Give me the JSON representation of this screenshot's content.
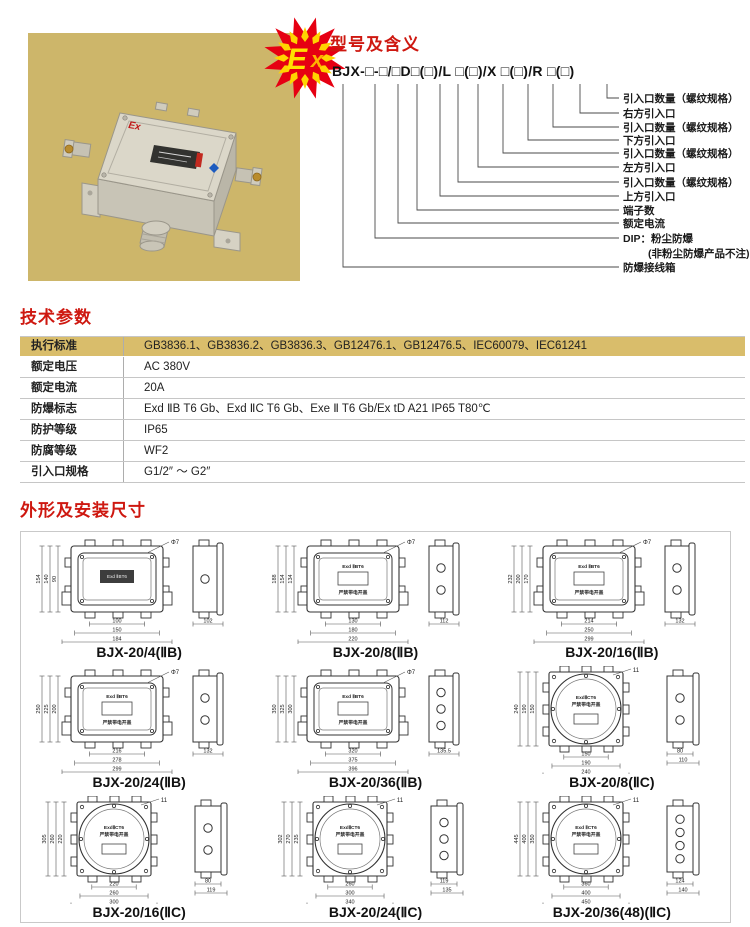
{
  "product_photo": {
    "bg_color": "#cdb66a",
    "ex_badge_text": "Ex",
    "box_mark": "Ex",
    "badge_red": "#e60012",
    "badge_yellow": "#ffe100"
  },
  "model_section": {
    "title": "型号及含义",
    "model_string": "BJX-□-□/□D□(□)/L □(□)/X □(□)/R □(□)",
    "labels": [
      "引入口数量（螺纹规格）",
      "右方引入口",
      "引入口数量（螺纹规格）",
      "下方引入口",
      "引入口数量（螺纹规格）",
      "左方引入口",
      "引入口数量（螺纹规格）",
      "上方引入口",
      "端子数",
      "额定电流",
      "DIP：粉尘防爆",
      "防爆接线箱"
    ],
    "dip_note": "(非粉尘防爆产品不注)"
  },
  "tech_params": {
    "title": "技术参数",
    "rows": [
      {
        "label": "执行标准",
        "value": "GB3836.1、GB3836.2、GB3836.3、GB12476.1、GB12476.5、IEC60079、IEC61241"
      },
      {
        "label": "额定电压",
        "value": "AC 380V"
      },
      {
        "label": "额定电流",
        "value": "20A"
      },
      {
        "label": "防爆标志",
        "value": "Exd ⅡB T6 Gb、Exd ⅡC T6 Gb、Exe Ⅱ T6 Gb/Ex tD A21 IP65 T80℃"
      },
      {
        "label": "防护等级",
        "value": "IP65"
      },
      {
        "label": "防腐等级",
        "value": "WF2"
      },
      {
        "label": "引入口规格",
        "value": "G1/2″ ～ G2″"
      }
    ]
  },
  "dimensions_section": {
    "title": "外形及安装尺寸",
    "figures": [
      {
        "label": "BJX-20/4(ⅡB)",
        "style": "rect",
        "dark_plate": true,
        "plate": [
          "Exd ⅡBT6",
          ""
        ],
        "top_dim": "Φ7",
        "bottom_dims": [
          "100",
          "150",
          "184"
        ],
        "left_dims": [
          "90",
          "140",
          "154"
        ],
        "side_dims": [
          "102"
        ],
        "holes": 1
      },
      {
        "label": "BJX-20/8(ⅡB)",
        "style": "rect",
        "dark_plate": false,
        "plate": [
          "Exd ⅡBT6",
          "严禁带电开盖"
        ],
        "top_dim": "Φ7",
        "bottom_dims": [
          "130",
          "180",
          "220"
        ],
        "left_dims": [
          "134",
          "154",
          "188"
        ],
        "side_dims": [
          "112"
        ],
        "holes": 2
      },
      {
        "label": "BJX-20/16(ⅡB)",
        "style": "rect",
        "dark_plate": false,
        "plate": [
          "Exd ⅡBT6",
          "严禁带电开盖"
        ],
        "top_dim": "Φ7",
        "bottom_dims": [
          "214",
          "250",
          "299"
        ],
        "left_dims": [
          "170",
          "200",
          "232"
        ],
        "side_dims": [
          "132"
        ],
        "holes": 2
      },
      {
        "label": "BJX-20/24(ⅡB)",
        "style": "rect",
        "dark_plate": false,
        "plate": [
          "Exd ⅡBT6",
          "严禁带电开盖"
        ],
        "top_dim": "Φ7",
        "bottom_dims": [
          "216",
          "278",
          "299"
        ],
        "left_dims": [
          "200",
          "225",
          "250"
        ],
        "side_dims": [
          "132"
        ],
        "holes": 2
      },
      {
        "label": "BJX-20/36(ⅡB)",
        "style": "rect",
        "dark_plate": false,
        "plate": [
          "Exd ⅡBT6",
          "严禁带电开盖"
        ],
        "top_dim": "Φ7",
        "bottom_dims": [
          "320",
          "375",
          "396"
        ],
        "left_dims": [
          "300",
          "325",
          "350"
        ],
        "side_dims": [
          "135.5"
        ],
        "holes": 3
      },
      {
        "label": "BJX-20/8(ⅡC)",
        "style": "round",
        "dark_plate": false,
        "plate": [
          "ExdⅡCT6",
          "严禁带电开盖"
        ],
        "top_dim": "11",
        "bottom_dims": [
          "150",
          "190",
          "240"
        ],
        "left_dims": [
          "150",
          "190",
          "240"
        ],
        "side_dims": [
          "80",
          "110"
        ],
        "holes": 2
      },
      {
        "label": "BJX-20/16(ⅡC)",
        "style": "round",
        "dark_plate": false,
        "plate": [
          "ExdⅡCT6",
          "严禁带电开盖"
        ],
        "top_dim": "11",
        "bottom_dims": [
          "220",
          "260",
          "300"
        ],
        "left_dims": [
          "220",
          "260",
          "305"
        ],
        "side_dims": [
          "80",
          "119"
        ],
        "holes": 2
      },
      {
        "label": "BJX-20/24(ⅡC)",
        "style": "round",
        "dark_plate": false,
        "plate": [
          "ExdⅡCT6",
          "严禁带电开盖"
        ],
        "top_dim": "11",
        "bottom_dims": [
          "260",
          "300",
          "340"
        ],
        "left_dims": [
          "235",
          "270",
          "302"
        ],
        "side_dims": [
          "119",
          "135"
        ],
        "holes": 3
      },
      {
        "label": "BJX-20/36(48)(ⅡC)",
        "style": "round",
        "dark_plate": false,
        "plate": [
          "Exd ⅡCT6",
          "严禁带电开盖"
        ],
        "top_dim": "11",
        "bottom_dims": [
          "360",
          "400",
          "450"
        ],
        "left_dims": [
          "350",
          "400",
          "445"
        ],
        "side_dims": [
          "124",
          "140"
        ],
        "holes": 4
      }
    ]
  }
}
